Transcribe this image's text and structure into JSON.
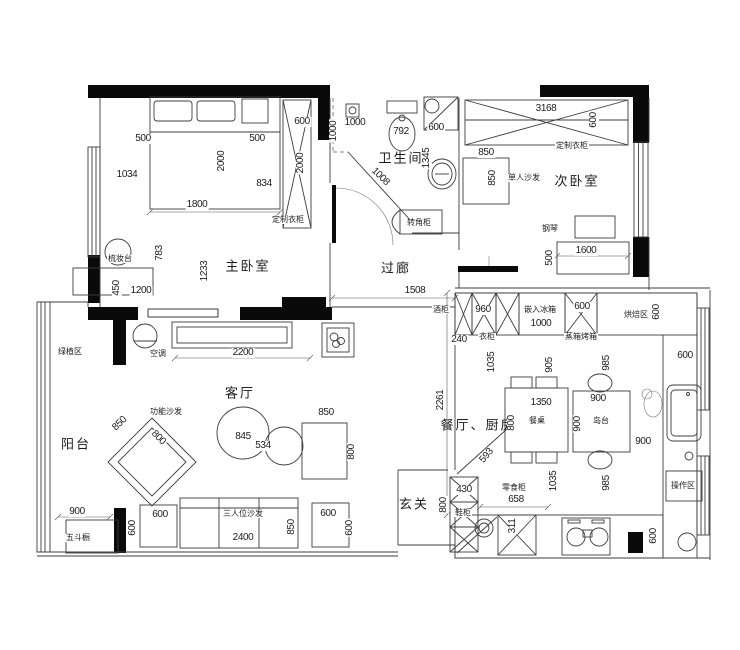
{
  "drawing": {
    "type": "apartment-floor-plan",
    "colors": {
      "line": "#3c3c3c",
      "wall": "#0a0a0a",
      "background": "#ffffff"
    }
  },
  "room_labels": [
    {
      "text": "卫生间",
      "x": 401,
      "y": 158
    },
    {
      "text": "次卧室",
      "x": 577,
      "y": 181
    },
    {
      "text": "主卧室",
      "x": 248,
      "y": 266
    },
    {
      "text": "过廊",
      "x": 396,
      "y": 268
    },
    {
      "text": "客厅",
      "x": 240,
      "y": 393
    },
    {
      "text": "阳台",
      "x": 76,
      "y": 444
    },
    {
      "text": "餐厅、厨房",
      "x": 478,
      "y": 425
    },
    {
      "text": "玄关",
      "x": 414,
      "y": 504
    }
  ],
  "furniture_labels": [
    {
      "text": "定制衣柜",
      "x": 288,
      "y": 220
    },
    {
      "text": "定制衣柜",
      "x": 572,
      "y": 146
    },
    {
      "text": "单人沙发",
      "x": 524,
      "y": 178
    },
    {
      "text": "梳妆台",
      "x": 120,
      "y": 259
    },
    {
      "text": "转角柜",
      "x": 419,
      "y": 223
    },
    {
      "text": "钢琴",
      "x": 550,
      "y": 229
    },
    {
      "text": "酒柜",
      "x": 441,
      "y": 310
    },
    {
      "text": "衣柜",
      "x": 487,
      "y": 337
    },
    {
      "text": "嵌入冰箱",
      "x": 540,
      "y": 310
    },
    {
      "text": "蒸箱烤箱",
      "x": 581,
      "y": 337
    },
    {
      "text": "烘焙区",
      "x": 636,
      "y": 315
    },
    {
      "text": "空调",
      "x": 158,
      "y": 354
    },
    {
      "text": "功能沙发",
      "x": 166,
      "y": 412
    },
    {
      "text": "绿植区",
      "x": 70,
      "y": 352
    },
    {
      "text": "五斗橱",
      "x": 78,
      "y": 538
    },
    {
      "text": "三人位沙发",
      "x": 243,
      "y": 514
    },
    {
      "text": "餐桌",
      "x": 537,
      "y": 421
    },
    {
      "text": "岛台",
      "x": 601,
      "y": 421
    },
    {
      "text": "操作区",
      "x": 683,
      "y": 486
    },
    {
      "text": "零食柜",
      "x": 514,
      "y": 488
    },
    {
      "text": "鞋柜",
      "x": 463,
      "y": 513
    }
  ],
  "dimensions": [
    {
      "text": "500",
      "x": 143,
      "y": 139,
      "rot": 0
    },
    {
      "text": "1034",
      "x": 127,
      "y": 175,
      "rot": 0
    },
    {
      "text": "2000",
      "x": 222,
      "y": 161,
      "rot": -90
    },
    {
      "text": "500",
      "x": 257,
      "y": 139,
      "rot": 0
    },
    {
      "text": "834",
      "x": 264,
      "y": 184,
      "rot": 0
    },
    {
      "text": "600",
      "x": 302,
      "y": 122,
      "rot": 0
    },
    {
      "text": "2000",
      "x": 301,
      "y": 163,
      "rot": -90
    },
    {
      "text": "1800",
      "x": 197,
      "y": 205,
      "rot": 0
    },
    {
      "text": "783",
      "x": 160,
      "y": 253,
      "rot": -90
    },
    {
      "text": "1233",
      "x": 205,
      "y": 271,
      "rot": -90
    },
    {
      "text": "450",
      "x": 117,
      "y": 288,
      "rot": -90
    },
    {
      "text": "1200",
      "x": 141,
      "y": 291,
      "rot": 0
    },
    {
      "text": "1000",
      "x": 355,
      "y": 123,
      "rot": 0
    },
    {
      "text": "1000",
      "x": 334,
      "y": 131,
      "rot": -90
    },
    {
      "text": "792",
      "x": 401,
      "y": 132,
      "rot": 0
    },
    {
      "text": "600",
      "x": 436,
      "y": 128,
      "rot": 0
    },
    {
      "text": "1345",
      "x": 427,
      "y": 158,
      "rot": -90
    },
    {
      "text": "1008",
      "x": 380,
      "y": 177,
      "rot": 45
    },
    {
      "text": "850",
      "x": 486,
      "y": 153,
      "rot": 0
    },
    {
      "text": "850",
      "x": 493,
      "y": 178,
      "rot": -90
    },
    {
      "text": "3168",
      "x": 546,
      "y": 109,
      "rot": 0
    },
    {
      "text": "600",
      "x": 594,
      "y": 120,
      "rot": -90
    },
    {
      "text": "1600",
      "x": 586,
      "y": 251,
      "rot": 0
    },
    {
      "text": "500",
      "x": 550,
      "y": 258,
      "rot": -90
    },
    {
      "text": "1508",
      "x": 415,
      "y": 291,
      "rot": 0
    },
    {
      "text": "240",
      "x": 459,
      "y": 340,
      "rot": 0
    },
    {
      "text": "960",
      "x": 483,
      "y": 310,
      "rot": 0
    },
    {
      "text": "1000",
      "x": 541,
      "y": 324,
      "rot": 0
    },
    {
      "text": "600",
      "x": 582,
      "y": 307,
      "rot": 0
    },
    {
      "text": "600",
      "x": 657,
      "y": 312,
      "rot": -90
    },
    {
      "text": "1035",
      "x": 492,
      "y": 362,
      "rot": -90
    },
    {
      "text": "905",
      "x": 550,
      "y": 365,
      "rot": -90
    },
    {
      "text": "985",
      "x": 607,
      "y": 363,
      "rot": -90
    },
    {
      "text": "600",
      "x": 685,
      "y": 356,
      "rot": 0
    },
    {
      "text": "2261",
      "x": 441,
      "y": 400,
      "rot": -90
    },
    {
      "text": "1350",
      "x": 541,
      "y": 403,
      "rot": 0
    },
    {
      "text": "800",
      "x": 512,
      "y": 423,
      "rot": -90
    },
    {
      "text": "900",
      "x": 578,
      "y": 424,
      "rot": -90
    },
    {
      "text": "900",
      "x": 598,
      "y": 399,
      "rot": 0
    },
    {
      "text": "900",
      "x": 643,
      "y": 442,
      "rot": 0
    },
    {
      "text": "593",
      "x": 487,
      "y": 456,
      "rot": -50
    },
    {
      "text": "430",
      "x": 464,
      "y": 490,
      "rot": 0
    },
    {
      "text": "800",
      "x": 444,
      "y": 505,
      "rot": -90
    },
    {
      "text": "658",
      "x": 516,
      "y": 500,
      "rot": 0
    },
    {
      "text": "311",
      "x": 513,
      "y": 526,
      "rot": -90
    },
    {
      "text": "1035",
      "x": 554,
      "y": 481,
      "rot": -90
    },
    {
      "text": "985",
      "x": 607,
      "y": 483,
      "rot": -90
    },
    {
      "text": "600",
      "x": 654,
      "y": 536,
      "rot": -90
    },
    {
      "text": "2200",
      "x": 243,
      "y": 353,
      "rot": 0
    },
    {
      "text": "845",
      "x": 243,
      "y": 437,
      "rot": 0
    },
    {
      "text": "534",
      "x": 263,
      "y": 446,
      "rot": 0
    },
    {
      "text": "850",
      "x": 326,
      "y": 413,
      "rot": 0
    },
    {
      "text": "800",
      "x": 352,
      "y": 452,
      "rot": -90
    },
    {
      "text": "850",
      "x": 120,
      "y": 424,
      "rot": -45
    },
    {
      "text": "800",
      "x": 158,
      "y": 438,
      "rot": 45
    },
    {
      "text": "900",
      "x": 77,
      "y": 512,
      "rot": 0
    },
    {
      "text": "600",
      "x": 133,
      "y": 528,
      "rot": -90
    },
    {
      "text": "600",
      "x": 160,
      "y": 515,
      "rot": 0
    },
    {
      "text": "2400",
      "x": 243,
      "y": 538,
      "rot": 0
    },
    {
      "text": "850",
      "x": 292,
      "y": 527,
      "rot": -90
    },
    {
      "text": "600",
      "x": 328,
      "y": 514,
      "rot": 0
    },
    {
      "text": "600",
      "x": 350,
      "y": 528,
      "rot": -90
    }
  ]
}
